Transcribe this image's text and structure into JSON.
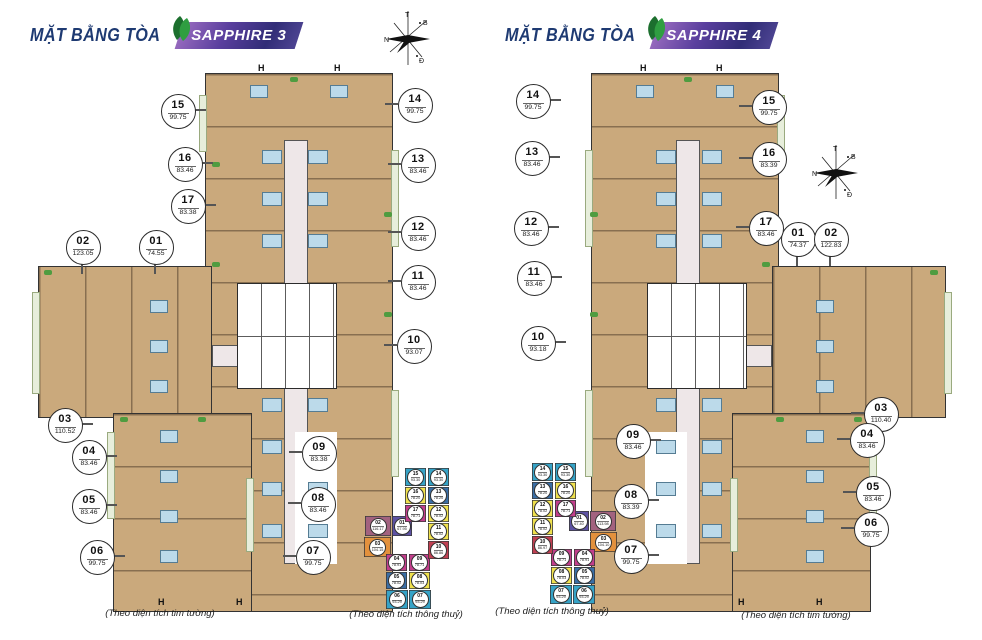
{
  "page": {
    "title_prefix": "MẶT BẰNG TÒA"
  },
  "compass": {
    "top": "T",
    "right": "B",
    "left": "N",
    "bottom": "Đ"
  },
  "plan_marks": {
    "hatch": "H"
  },
  "towers": [
    {
      "name": "SAPPHIRE 3",
      "caption": "(Theo diện tích tim tường)",
      "mini_caption": "(Theo diện tích thông thuỷ)",
      "units": [
        {
          "no": "01",
          "area": "74.55"
        },
        {
          "no": "02",
          "area": "123.05"
        },
        {
          "no": "03",
          "area": "110.52"
        },
        {
          "no": "04",
          "area": "83.46"
        },
        {
          "no": "05",
          "area": "83.46"
        },
        {
          "no": "06",
          "area": "99.75"
        },
        {
          "no": "07",
          "area": "99.75"
        },
        {
          "no": "08",
          "area": "83.46"
        },
        {
          "no": "09",
          "area": "83.38"
        },
        {
          "no": "10",
          "area": "93.07"
        },
        {
          "no": "11",
          "area": "83.46"
        },
        {
          "no": "12",
          "area": "83.46"
        },
        {
          "no": "13",
          "area": "83.46"
        },
        {
          "no": "14",
          "area": "99.75"
        },
        {
          "no": "15",
          "area": "99.75"
        },
        {
          "no": "16",
          "area": "83.46"
        },
        {
          "no": "17",
          "area": "83.38"
        }
      ],
      "mini_units": [
        {
          "no": "01",
          "area": "67.95",
          "color": "#5d52a3"
        },
        {
          "no": "02",
          "area": "116.17",
          "color": "#a2627f"
        },
        {
          "no": "03",
          "area": "104.15",
          "color": "#e3913d"
        },
        {
          "no": "04",
          "area": "78.91",
          "color": "#c23e8c"
        },
        {
          "no": "05",
          "area": "78.02",
          "color": "#3a6ea5"
        },
        {
          "no": "06",
          "area": "93.29",
          "color": "#36a3c7"
        },
        {
          "no": "07",
          "area": "93.29",
          "color": "#36a3c7"
        },
        {
          "no": "08",
          "area": "78.03",
          "color": "#f0e14d"
        },
        {
          "no": "09",
          "area": "78.71",
          "color": "#c23e8c"
        },
        {
          "no": "10",
          "area": "86.86",
          "color": "#c04052"
        },
        {
          "no": "11",
          "area": "78.02",
          "color": "#f0e14d"
        },
        {
          "no": "12",
          "area": "78.02",
          "color": "#f0e14d"
        },
        {
          "no": "13",
          "area": "78.20",
          "color": "#3a6ea5"
        },
        {
          "no": "14",
          "area": "93.30",
          "color": "#36a3c7"
        },
        {
          "no": "15",
          "area": "93.30",
          "color": "#36a3c7"
        },
        {
          "no": "16",
          "area": "78.20",
          "color": "#f0e14d"
        },
        {
          "no": "17",
          "area": "78.71",
          "color": "#c23e8c"
        }
      ]
    },
    {
      "name": "SAPPHIRE 4",
      "caption": "(Theo diện tích tim tường)",
      "mini_caption": "(Theo diện tích thông thuỷ)",
      "units": [
        {
          "no": "01",
          "area": "74.37"
        },
        {
          "no": "02",
          "area": "122.83"
        },
        {
          "no": "03",
          "area": "110.40"
        },
        {
          "no": "04",
          "area": "83.46"
        },
        {
          "no": "05",
          "area": "83.46"
        },
        {
          "no": "06",
          "area": "99.75"
        },
        {
          "no": "07",
          "area": "99.75"
        },
        {
          "no": "08",
          "area": "83.39"
        },
        {
          "no": "09",
          "area": "83.46"
        },
        {
          "no": "10",
          "area": "93.18"
        },
        {
          "no": "11",
          "area": "83.46"
        },
        {
          "no": "12",
          "area": "83.46"
        },
        {
          "no": "13",
          "area": "83.46"
        },
        {
          "no": "14",
          "area": "99.75"
        },
        {
          "no": "15",
          "area": "99.75"
        },
        {
          "no": "16",
          "area": "83.39"
        },
        {
          "no": "17",
          "area": "83.46"
        }
      ],
      "mini_units": [
        {
          "no": "01",
          "area": "67.40",
          "color": "#5d52a3"
        },
        {
          "no": "02",
          "area": "113.98",
          "color": "#a2627f"
        },
        {
          "no": "03",
          "area": "104.10",
          "color": "#e3913d"
        },
        {
          "no": "04",
          "area": "78.91",
          "color": "#c23e8c"
        },
        {
          "no": "05",
          "area": "78.02",
          "color": "#3a6ea5"
        },
        {
          "no": "06",
          "area": "93.29",
          "color": "#36a3c7"
        },
        {
          "no": "07",
          "area": "93.29",
          "color": "#36a3c7"
        },
        {
          "no": "08",
          "area": "78.03",
          "color": "#f0e14d"
        },
        {
          "no": "09",
          "area": "78.71",
          "color": "#c23e8c"
        },
        {
          "no": "10",
          "area": "86.97",
          "color": "#c04052"
        },
        {
          "no": "11",
          "area": "78.02",
          "color": "#f0e14d"
        },
        {
          "no": "12",
          "area": "78.02",
          "color": "#f0e14d"
        },
        {
          "no": "13",
          "area": "78.20",
          "color": "#3a6ea5"
        },
        {
          "no": "14",
          "area": "93.30",
          "color": "#36a3c7"
        },
        {
          "no": "15",
          "area": "93.30",
          "color": "#36a3c7"
        },
        {
          "no": "16",
          "area": "78.20",
          "color": "#f0e14d"
        },
        {
          "no": "17",
          "area": "78.71",
          "color": "#c23e8c"
        }
      ]
    }
  ]
}
